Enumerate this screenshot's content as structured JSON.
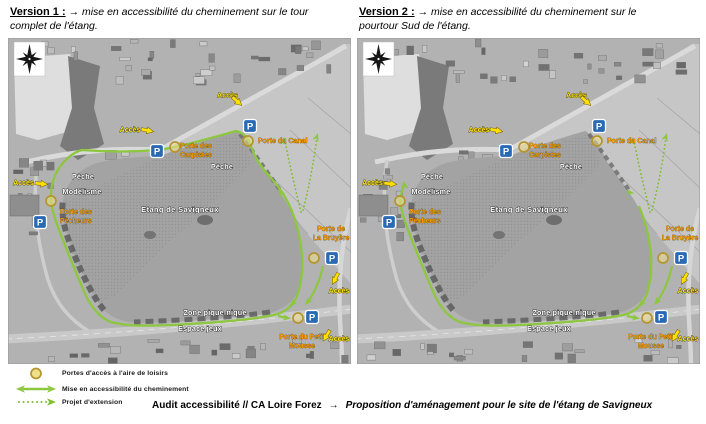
{
  "version1": {
    "title": "Version 1 :",
    "desc": "→ mise en accessibilité du cheminement sur le tour complet de l'étang."
  },
  "version2": {
    "title": "Version 2 :",
    "desc": "→ mise en accessibilité du cheminement sur le pourtour Sud de l'étang."
  },
  "map_labels": {
    "lake": "Etang de Savigneux",
    "acces": "Accès",
    "peche": "Pêche",
    "modelisme": "Modélisme",
    "zone_pique_nique": "Zone pique-nique",
    "espace_jeux": "Espace jeux",
    "parking": "P",
    "porte_canal": [
      "Porte du Canal"
    ],
    "porte_carpistes": [
      "Porte des",
      "Carpistes"
    ],
    "porte_pecheurs": [
      "Porte des",
      "Pêcheurs"
    ],
    "porte_bruyere": [
      "Porte de",
      "La Bruyère"
    ],
    "porte_petit_mousse": [
      "Porte du Petit",
      "Mousse"
    ]
  },
  "legend": {
    "items": [
      {
        "icon": "porte-circle",
        "label": "Portes d'accès à l'aire de loisirs"
      },
      {
        "icon": "green-double-arrow",
        "label": "Mise en accessibilité du cheminement"
      },
      {
        "icon": "green-dotted-arrow",
        "label": "Projet d'extension"
      }
    ]
  },
  "footer": {
    "left": "Audit accessibilité // CA Loire Forez",
    "arrow": "→",
    "right": "Proposition d'aménagement pour le site de l'étang de Savigneux"
  },
  "colors": {
    "path_green": "#8dc63f",
    "dotted_green": "#7fbe32",
    "acces_yellow": "#ffe000",
    "porte_orange": "#f59b00",
    "parking_blue": "#2a6ab5",
    "porte_circle_fill": "#efe08a",
    "porte_circle_stroke": "#b5952f"
  }
}
